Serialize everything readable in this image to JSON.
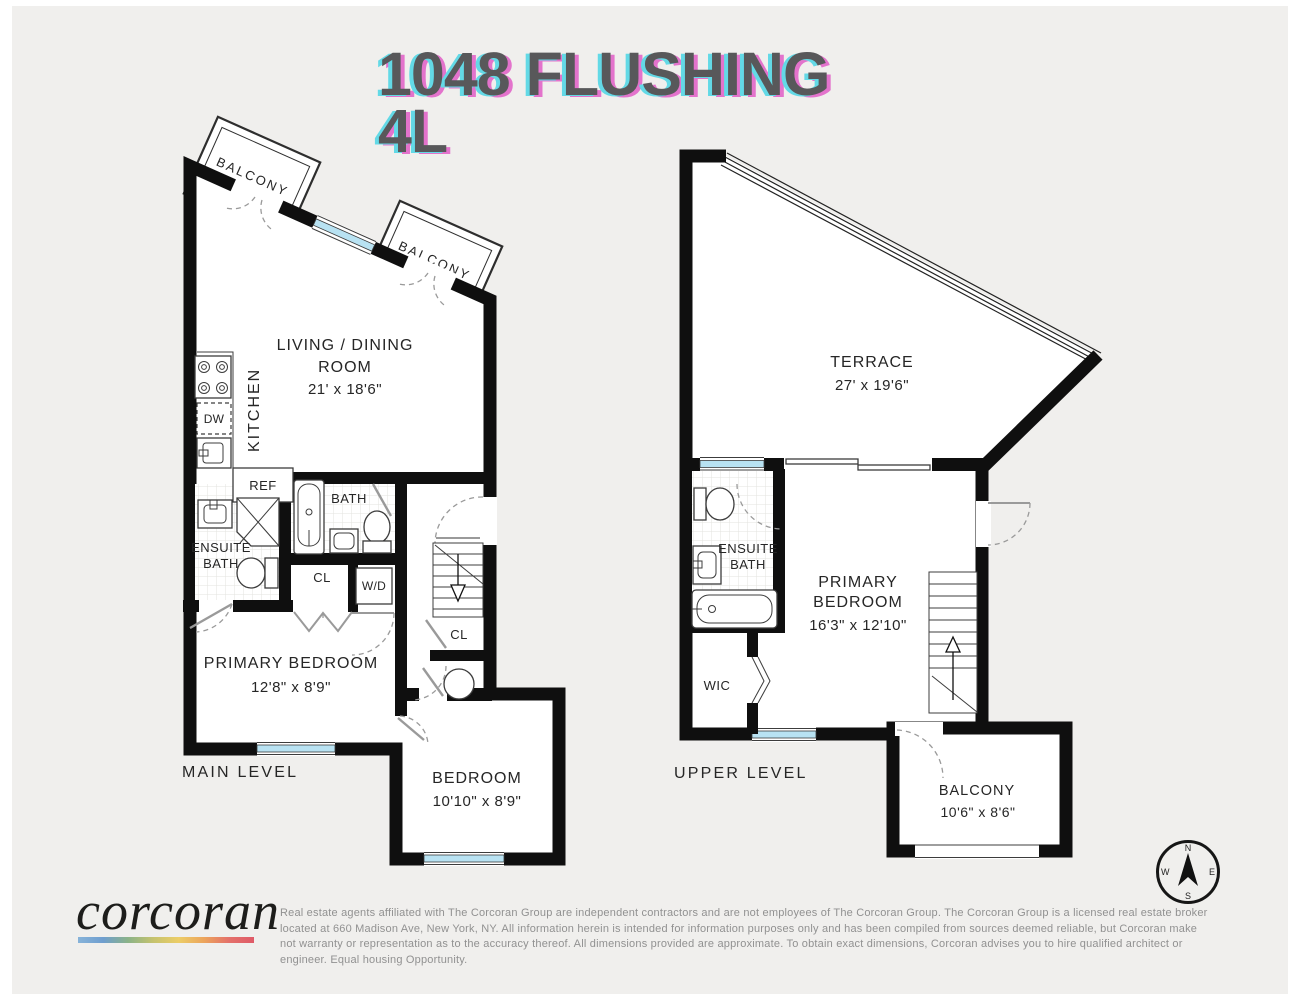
{
  "title": {
    "line1": "1048 FLUSHING",
    "line2": "4L"
  },
  "levels": {
    "main": {
      "caption": "MAIN LEVEL",
      "balcony_1": "BALCONY",
      "balcony_2": "BALCONY",
      "living_dining": {
        "line1": "LIVING / DINING",
        "line2": "ROOM",
        "dims": "21' x 18'6\""
      },
      "kitchen": "KITCHEN",
      "dw": "DW",
      "ref": "REF",
      "bath": "BATH",
      "ensuite": {
        "line1": "ENSUITE",
        "line2": "BATH"
      },
      "closet_hall": "CL",
      "washer_dryer": "W/D",
      "closet_stairs": "CL",
      "primary_bedroom": {
        "name": "PRIMARY BEDROOM",
        "dims": "12'8\" x 8'9\""
      },
      "bedroom": {
        "name": "BEDROOM",
        "dims": "10'10\" x 8'9\""
      }
    },
    "upper": {
      "caption": "UPPER LEVEL",
      "terrace": {
        "name": "TERRACE",
        "dims": "27' x 19'6\""
      },
      "ensuite": {
        "line1": "ENSUITE",
        "line2": "BATH"
      },
      "primary_bedroom": {
        "line1": "PRIMARY",
        "line2": "BEDROOM",
        "dims": "16'3\" x 12'10\""
      },
      "wic": "WIC",
      "balcony": {
        "name": "BALCONY",
        "dims": "10'6\" x 8'6\""
      }
    }
  },
  "compass": {
    "n": "N",
    "e": "E",
    "s": "S",
    "w": "W"
  },
  "footer": {
    "brand": "corcoran",
    "gradient": [
      "#87b3d9",
      "#6f9ecf",
      "#8bb387",
      "#c6c36e",
      "#eccd66",
      "#eca55c",
      "#e4716a",
      "#df5a68"
    ],
    "disclaimer": "Real estate agents affiliated with The Corcoran Group are independent contractors and are not employees of The Corcoran Group. The Corcoran Group is a licensed real estate broker located at 660 Madison Ave, New York, NY. All information herein is intended for information purposes only and has been compiled from sources deemed reliable, but Corcoran make not warranty or representation as to the accuracy thereof. All dimensions provided are approximate. To obtain exact dimensions, Corcoran advises you to hire qualified architect or engineer. Equal housing Opportunity."
  },
  "colors": {
    "background": "#f0efed",
    "wall": "#0f0f0f",
    "window_glass": "#b8e2f2",
    "title_text": "#58585a",
    "title_shadow_cyan": "#63d9e6",
    "title_shadow_magenta": "#e373cc",
    "line": "#3c3c3c",
    "door": "#9a9a9a",
    "text": "#262626",
    "disclaimer_text": "#919191"
  }
}
